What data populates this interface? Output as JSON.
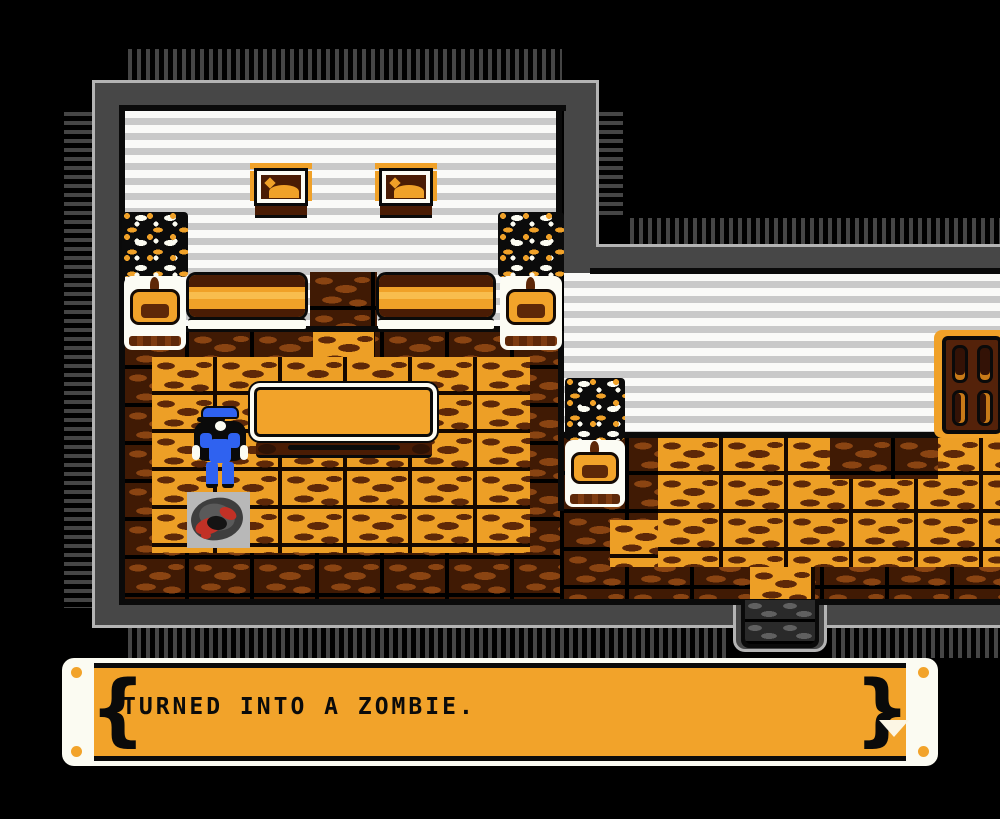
{
  "dialog": {
    "text": "TURNED INTO A ZOMBIE.",
    "advance_icon": "down-arrow"
  },
  "scene": {
    "sprites": [
      {
        "name": "police-officer",
        "color": "#2F62F0"
      },
      {
        "name": "zombie-corpse",
        "color": "#C23126"
      }
    ],
    "furniture": [
      "bed",
      "bed",
      "framed-picture",
      "framed-picture",
      "potted-plant",
      "potted-plant",
      "potted-plant",
      "table",
      "door",
      "floor-hatch-exit"
    ]
  },
  "colors": {
    "background": "#000000",
    "accent_orange": "#F2A32A",
    "wall_gray": "#474747",
    "wall_highlight": "#B4B4B4",
    "wall_stripe_light": "#FAFAF8",
    "wall_stripe_dark": "#C9C9C9",
    "floor_brick_orange": "#ED9F26",
    "floor_brick_dark": "#401A04",
    "sprite_blue": "#2F62F0",
    "blood_red": "#C23126"
  }
}
